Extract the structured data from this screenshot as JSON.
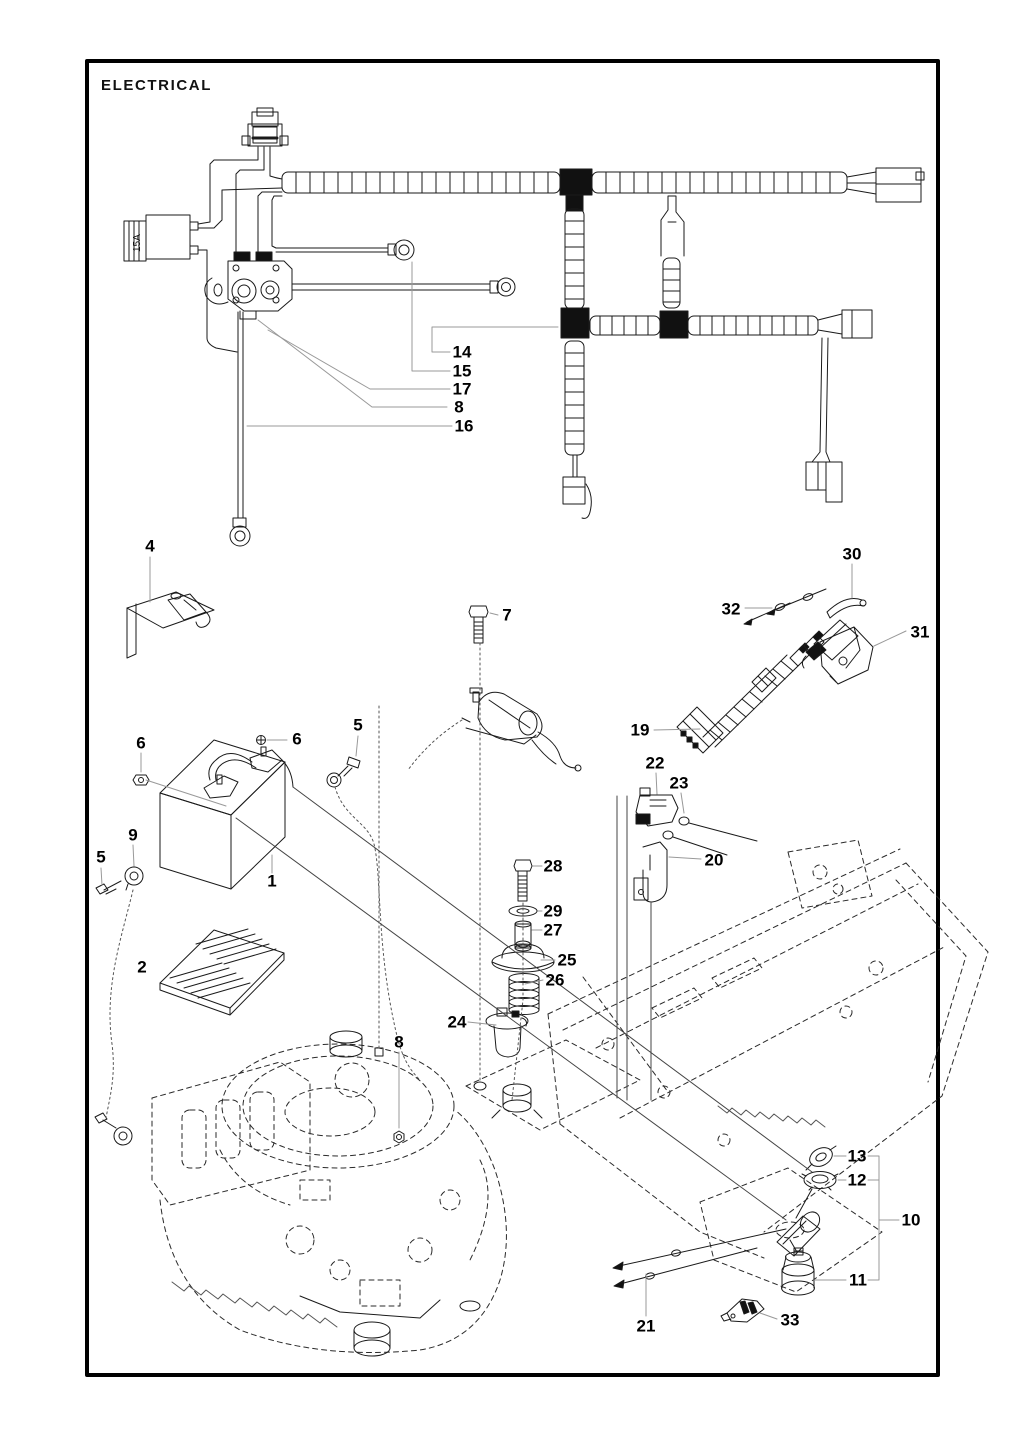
{
  "title": "ELECTRICAL",
  "diagram": {
    "type": "exploded-parts-diagram",
    "subject": "Electrical system: wiring harness, fuse, solenoid, battery, switches, ignition key and mounting hardware with phantom engine and chassis",
    "fuse_label": "15A",
    "line_color": "#1a1a1a",
    "leader_color": "#999999",
    "phantom_style": "dashed"
  },
  "callouts": [
    {
      "label": "14",
      "x": 462,
      "y": 352
    },
    {
      "label": "15",
      "x": 462,
      "y": 371
    },
    {
      "label": "17",
      "x": 462,
      "y": 389
    },
    {
      "label": "8",
      "x": 459,
      "y": 407
    },
    {
      "label": "16",
      "x": 464,
      "y": 426
    },
    {
      "label": "4",
      "x": 150,
      "y": 546
    },
    {
      "label": "7",
      "x": 507,
      "y": 615
    },
    {
      "label": "30",
      "x": 852,
      "y": 554
    },
    {
      "label": "32",
      "x": 731,
      "y": 609
    },
    {
      "label": "31",
      "x": 920,
      "y": 632
    },
    {
      "label": "19",
      "x": 640,
      "y": 730
    },
    {
      "label": "5",
      "x": 358,
      "y": 725
    },
    {
      "label": "6",
      "x": 141,
      "y": 743
    },
    {
      "label": "6",
      "x": 297,
      "y": 739
    },
    {
      "label": "22",
      "x": 655,
      "y": 763
    },
    {
      "label": "23",
      "x": 679,
      "y": 783
    },
    {
      "label": "9",
      "x": 133,
      "y": 835
    },
    {
      "label": "5",
      "x": 101,
      "y": 857
    },
    {
      "label": "20",
      "x": 714,
      "y": 860
    },
    {
      "label": "28",
      "x": 553,
      "y": 866
    },
    {
      "label": "1",
      "x": 272,
      "y": 881
    },
    {
      "label": "29",
      "x": 553,
      "y": 911
    },
    {
      "label": "27",
      "x": 553,
      "y": 930
    },
    {
      "label": "25",
      "x": 567,
      "y": 960
    },
    {
      "label": "2",
      "x": 142,
      "y": 967
    },
    {
      "label": "26",
      "x": 555,
      "y": 980
    },
    {
      "label": "24",
      "x": 457,
      "y": 1022
    },
    {
      "label": "8",
      "x": 399,
      "y": 1042
    },
    {
      "label": "13",
      "x": 857,
      "y": 1156
    },
    {
      "label": "12",
      "x": 857,
      "y": 1180
    },
    {
      "label": "10",
      "x": 911,
      "y": 1220
    },
    {
      "label": "11",
      "x": 858,
      "y": 1280
    },
    {
      "label": "21",
      "x": 646,
      "y": 1326
    },
    {
      "label": "33",
      "x": 790,
      "y": 1320
    }
  ]
}
